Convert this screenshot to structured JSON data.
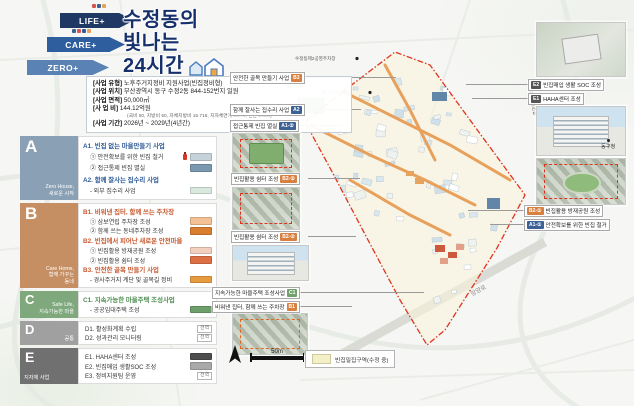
{
  "header": {
    "arrows": [
      {
        "label": "LIFE+",
        "color": "#203864"
      },
      {
        "label": "CARE+",
        "color": "#2e5e9e"
      },
      {
        "label": "ZERO+",
        "color": "#5b82b4"
      }
    ],
    "title_line1": "수정동의",
    "title_line2": "빛나는",
    "title_line3": "24시간"
  },
  "project_info": {
    "rows": [
      {
        "label": "[사업 유형]",
        "value": "노후주거지정비 지원사업(빈집정비형)"
      },
      {
        "label": "[사업 위치]",
        "value": "부산광역시 동구 수정2동 844-152번지 일원"
      },
      {
        "label": "[사업 면적]",
        "value": "50,000㎡"
      },
      {
        "label": "[사 업 비]",
        "value": "144.12억원"
      },
      {
        "label": "",
        "value": "(국비 50, 지방비 50, 자체지방비 15.716, 지자체연계 26.74, 민간 1.664)"
      },
      {
        "label": "[사업 기간]",
        "value": "2026년 ~ 2029년(4년간)"
      }
    ]
  },
  "sections": [
    {
      "letter": "A",
      "subtitle": "Zero House,\n새로운 시작",
      "color": "#8aa0b4",
      "rows": [
        {
          "kind": "h",
          "text": "A1. 빈집 없는 마을만들기 사업",
          "color": "#2f5b97"
        },
        {
          "kind": "i",
          "text": "① 안전확보를 위한 빈집 철거",
          "swatch": "#c6d2d9"
        },
        {
          "kind": "i",
          "text": "② 접근통제 빈집 멸실",
          "swatch": "#7a99b0"
        },
        {
          "kind": "h",
          "text": "A2. 함께 잘사는 집수리 사업",
          "color": "#2f5b97"
        },
        {
          "kind": "i",
          "text": "- 외부 집수리 사업",
          "swatch": "#d9e9dd"
        }
      ]
    },
    {
      "letter": "B",
      "subtitle": "Care Home,\n함께 가꾸는\n동네",
      "color": "#c68f63",
      "rows": [
        {
          "kind": "h",
          "text": "B1. 비워낸 집터, 함께 쓰는 주차장",
          "color": "#c75b32"
        },
        {
          "kind": "i",
          "text": "① 삼보연립 주차장 조성",
          "swatch": "#f3c193"
        },
        {
          "kind": "i",
          "text": "② 함께 쓰는 동네주차장 조성",
          "swatch": "#d97e2f"
        },
        {
          "kind": "h",
          "text": "B2. 빈집에서 피어난 새로운 안전마을",
          "color": "#c75b32"
        },
        {
          "kind": "i",
          "text": "① 빈집활용 방재공원 조성",
          "swatch": "#f3cfc0"
        },
        {
          "kind": "i",
          "text": "② 빈집활용 쉼터 조성",
          "swatch": "#dd6f45"
        },
        {
          "kind": "h",
          "text": "B3. 안전한 골목 만들기 사업",
          "color": "#c75b32"
        },
        {
          "kind": "i",
          "text": "- 경사주거지 계단 및 골목길 정비",
          "swatch": "#e79b3f"
        }
      ]
    },
    {
      "letter": "C",
      "subtitle": "Safe Life,\n지속가능한 마을",
      "color": "#7fa87c",
      "rows": [
        {
          "kind": "h",
          "text": "C1. 지속가능한 마을주택 조성사업",
          "color": "#4e8f52"
        },
        {
          "kind": "i",
          "text": "- 공공임대주택 조성",
          "swatch": "#6e9e6a"
        }
      ]
    },
    {
      "letter": "D",
      "subtitle": "공통",
      "color": "#a0a0a0",
      "rows": [
        {
          "kind": "i",
          "text": "D1. 활성화계획 수립",
          "tag": "전역"
        },
        {
          "kind": "i",
          "text": "D2. 성과관리 모니터링",
          "tag": "전역"
        }
      ]
    },
    {
      "letter": "E",
      "subtitle": "지자체 사업",
      "color": "#707070",
      "rows": [
        {
          "kind": "i",
          "text": "E1. HAHA센터 조성",
          "swatch": "#4d4d4d"
        },
        {
          "kind": "i",
          "text": "E2. 빈집매입 생활SOC 조성",
          "swatch": "#a9a9a9"
        },
        {
          "kind": "i",
          "text": "E3. 정비지원팀 운영",
          "tag": "전역"
        }
      ]
    }
  ],
  "callouts_left": [
    {
      "text": "안전한 골목 만들기 사업",
      "badge": "B3",
      "badge_color": "#d88040"
    },
    {
      "text": "함께 잘사는 집수리 사업",
      "badge": "A2",
      "badge_color": "#3c6295"
    },
    {
      "text": "접근통제 빈집 멸실",
      "badge": "A1-②",
      "badge_color": "#3c6295"
    },
    {
      "text": "빈집활용 쉼터 조성",
      "badge": "B2-②",
      "badge_color": "#d88040"
    },
    {
      "text": "빈집활용 쉼터 조성",
      "badge": "B2-②",
      "badge_color": "#d88040"
    },
    {
      "text": "지속가능한 마을주택 조성사업",
      "badge": "C1",
      "badge_color": "#71a06c"
    },
    {
      "text": "비워낸 집터, 함께 쓰는 주차장",
      "badge": "B1",
      "badge_color": "#d88040"
    }
  ],
  "callouts_right": [
    {
      "badge": "E2",
      "text": "빈집매입 생활 SOC 조성",
      "badge_color": "#555555"
    },
    {
      "badge": "E1",
      "text": "HAHA센터 조성",
      "badge_color": "#555555"
    },
    {
      "badge": "B2-①",
      "text": "빈집활용 방재공원 조성",
      "badge_color": "#d88040"
    },
    {
      "badge": "A1-①",
      "text": "안전확보를 위한 빈집 철거",
      "badge_color": "#3c6295"
    }
  ],
  "map": {
    "labels": {
      "parking": "수정동제2공영주차장",
      "civic": "동구행복민원실",
      "street_vertical": "수정동로1번길",
      "road_diagonal": "망양로",
      "district_office": "동구청"
    },
    "legend": {
      "scale": "50m",
      "swatch_label": "빈집밀집구역(수정 중)",
      "swatch_color": "#f3efc7"
    }
  }
}
